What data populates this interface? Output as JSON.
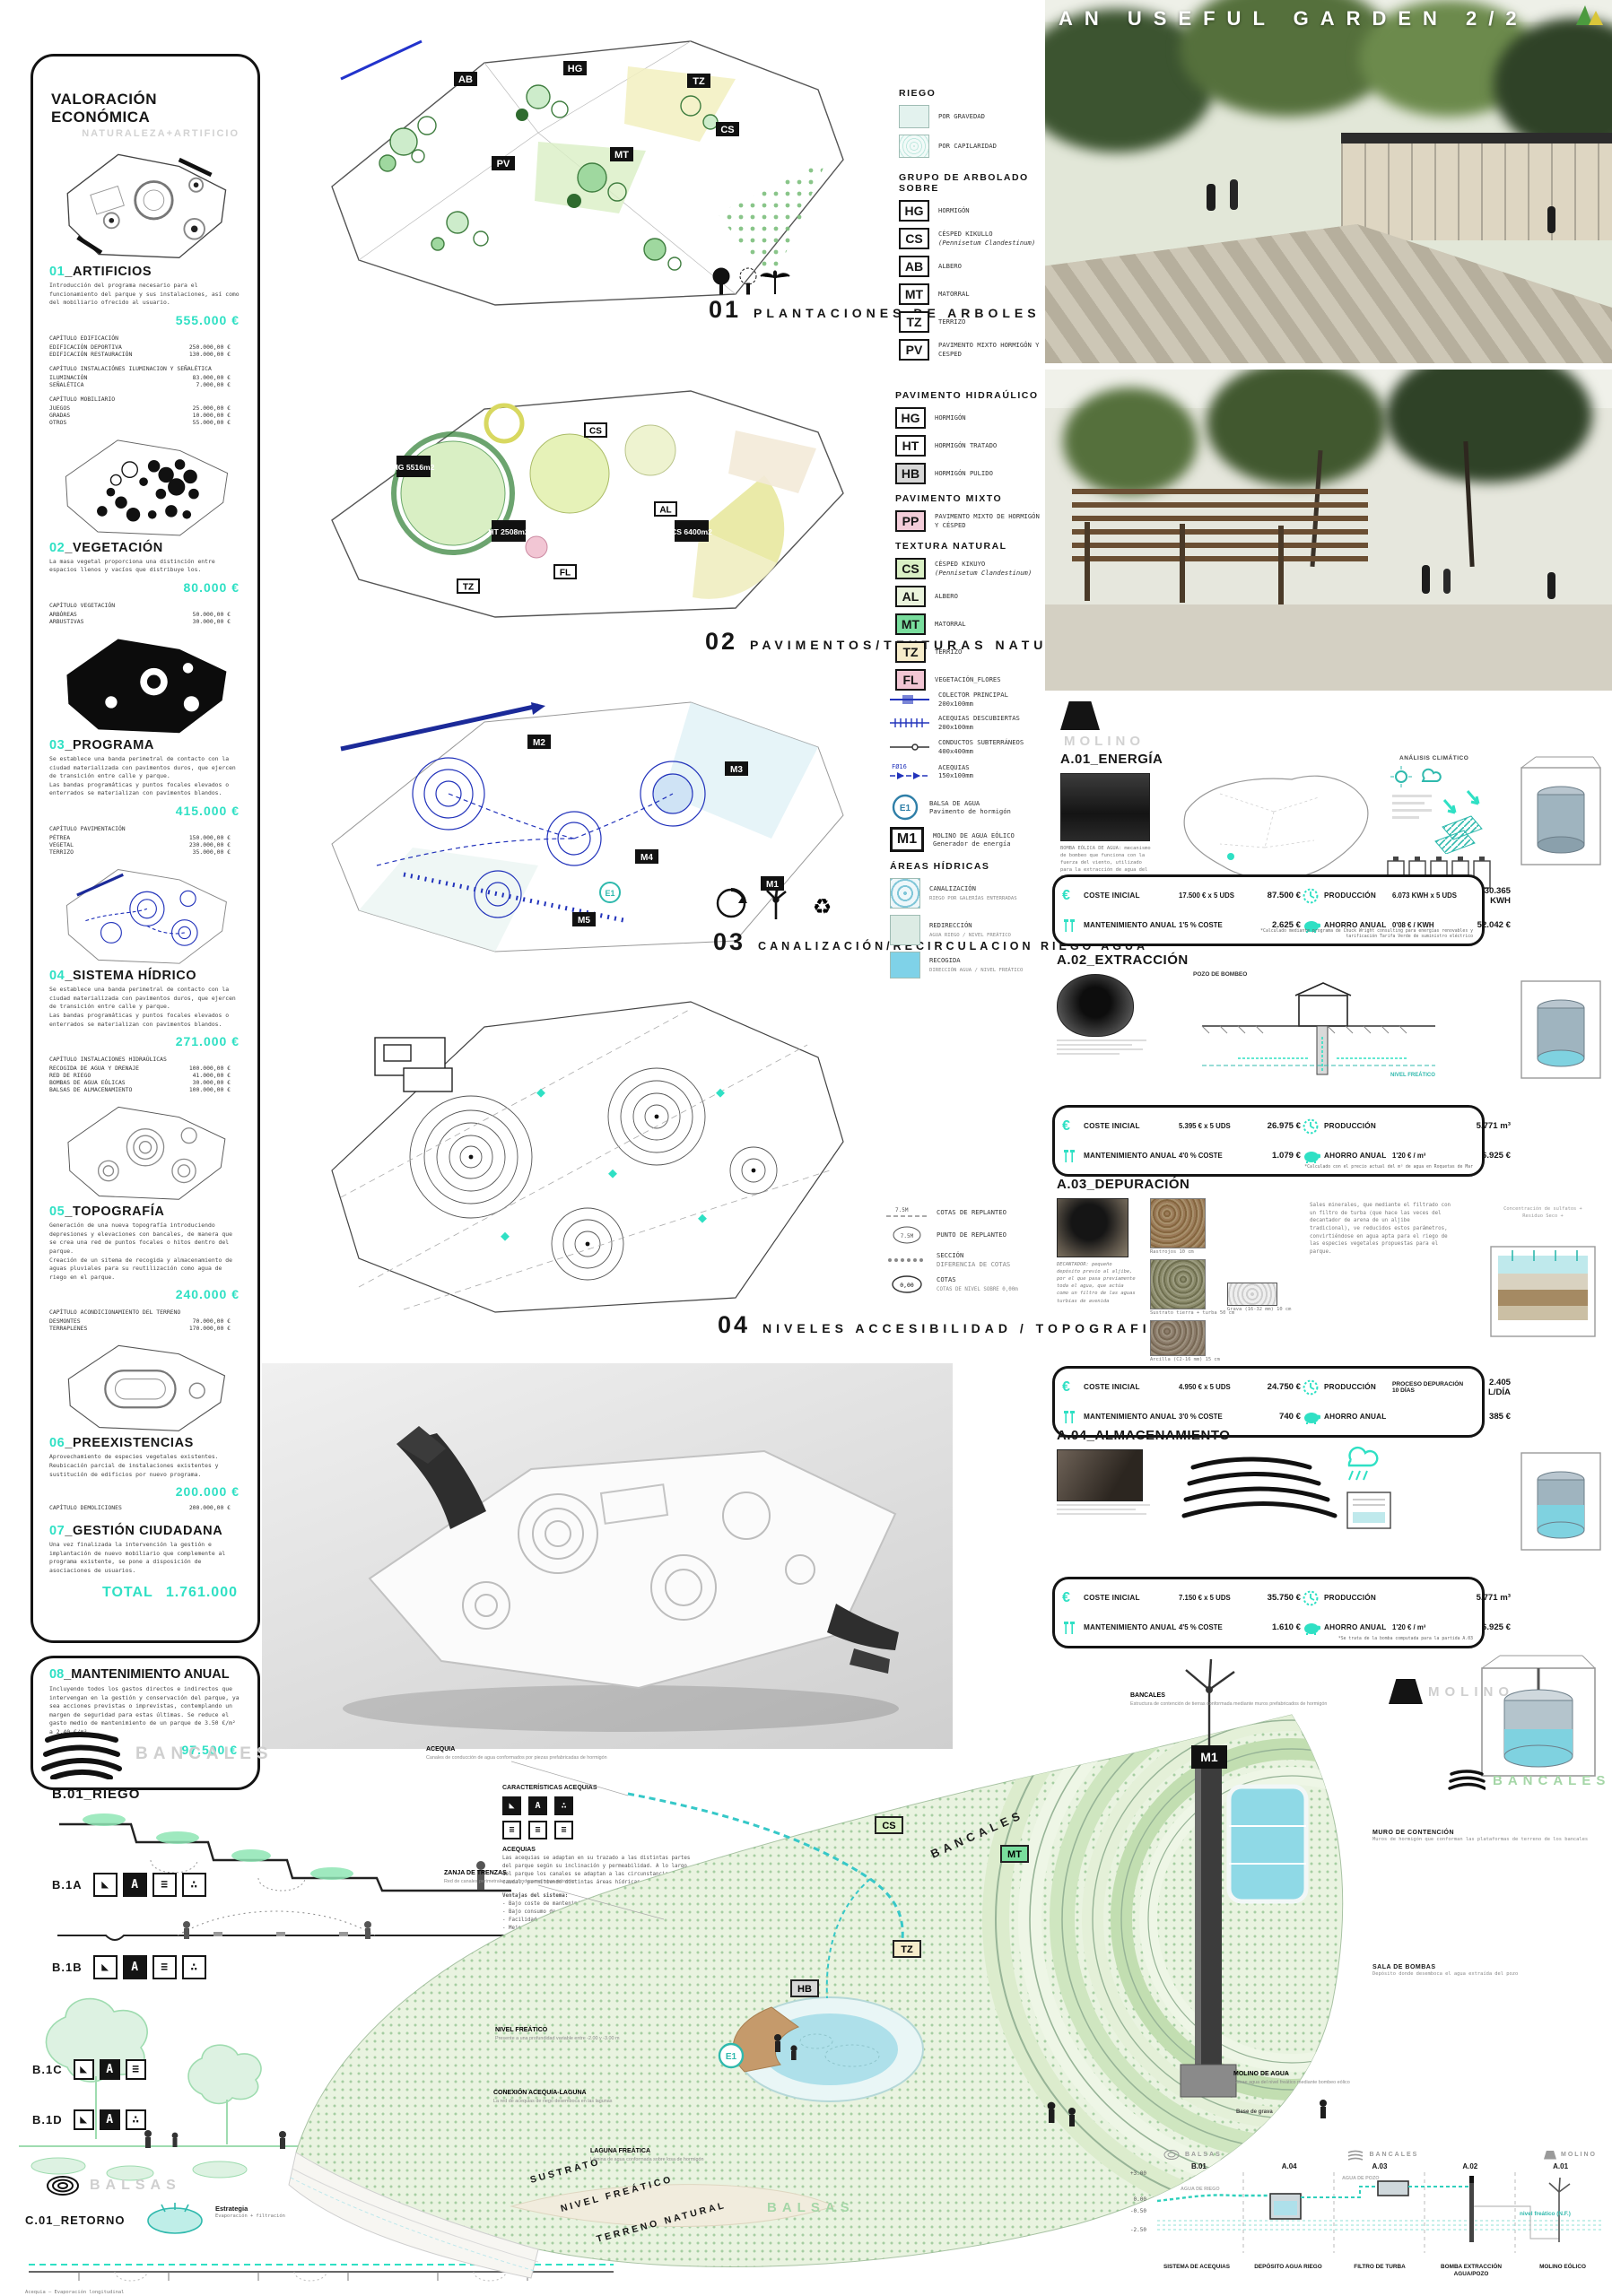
{
  "accent": "#2fe0c4",
  "title": "AN USEFUL GARDEN 2/2",
  "icons": {
    "euro": "€",
    "recycle": "♻"
  },
  "valuation": {
    "title": "VALORACIÓN ECONÓMICA",
    "subtitle": "NATURALEZA+ARTIFICIO",
    "sections": [
      {
        "num": "01",
        "name": "_ARTIFICIOS",
        "desc": "Introducción del programa necesario para el funcionamiento del parque y sus instalaciones, así como del mobiliario ofrecido al usuario.",
        "total": "555.000 €",
        "chapters": [
          {
            "title": "CAPÍTULO EDIFICACIÓN",
            "rows": [
              [
                "EDIFICACIÓN DEPORTIVA",
                "250.000,00 €"
              ],
              [
                "EDIFICACIÓN RESTAURACIÓN",
                "130.000,00 €"
              ]
            ]
          },
          {
            "title": "CAPÍTULO INSTALACIÓNES ILUMINACION Y SEÑALÉTICA",
            "rows": [
              [
                "ILUMINACIÓN",
                "83.000,00 €"
              ],
              [
                "SEÑALÉTICA",
                "7.000,00 €"
              ]
            ]
          },
          {
            "title": "CAPÍTULO MOBILIARIO",
            "rows": [
              [
                "JUEGOS",
                "25.000,00 €"
              ],
              [
                "GRADAS",
                "10.000,00 €"
              ],
              [
                "OTROS",
                "55.000,00 €"
              ]
            ]
          }
        ]
      },
      {
        "num": "02",
        "name": "_VEGETACIÓN",
        "desc": "La masa vegetal proporciona una distinción entre espacios llenos y vacíos que distribuye los.",
        "total": "80.000 €",
        "chapters": [
          {
            "title": "CAPÍTULO VEGETACIÓN",
            "rows": [
              [
                "ARBÓREAS",
                "50.000,00 €"
              ],
              [
                "ARBUSTIVAS",
                "30.000,00 €"
              ]
            ]
          }
        ]
      },
      {
        "num": "03",
        "name": "_PROGRAMA",
        "desc": "Se establece una banda perimetral de contacto con la ciudad materializada con pavimentos duros, que ejercen de transición entre calle y parque.\nLas bandas programáticas y puntos focales elevados o enterrados se materializan con pavimentos blandos.",
        "total": "415.000 €",
        "chapters": [
          {
            "title": "CAPÍTULO PAVIMENTACIÓN",
            "rows": [
              [
                "PÉTREA",
                "150.000,00 €"
              ],
              [
                "VEGETAL",
                "230.000,00 €"
              ],
              [
                "TERRIZO",
                "35.000,00 €"
              ]
            ]
          }
        ]
      },
      {
        "num": "04",
        "name": "_SISTEMA HÍDRICO",
        "desc": "Se establece una banda perimetral de contacto con la ciudad materializada con pavimentos duros, que ejercen de transición entre calle y parque.\nLas bandas programáticas y puntos focales elevados o enterrados se materializan con pavimentos blandos.",
        "total": "271.000 €",
        "chapters": [
          {
            "title": "CAPÍTULO INSTALACIONES HIDRAÚLICAS",
            "rows": [
              [
                "RECOGIDA DE AGUA Y DRENAJE",
                "100.000,00 €"
              ],
              [
                "RED DE RIEGO",
                "41.000,00 €"
              ],
              [
                "BOMBAS DE AGUA EÓLICAS",
                "30.000,00 €"
              ],
              [
                "BALSAS DE ALMACENAMIENTO",
                "100.000,00 €"
              ]
            ]
          }
        ]
      },
      {
        "num": "05",
        "name": "_TOPOGRAFÍA",
        "desc": "Generación de una nueva topografía introduciendo depresiones y elevaciones con bancales, de manera que se crea una red de puntos focales o hitos dentro del parque.\nCreación de un sitema de recogida y almacenamiento de aguas pluviales para su reutilización como agua de riego en el parque.",
        "total": "240.000 €",
        "chapters": [
          {
            "title": "CAPÍTULO ACONDICIONAMIENTO DEL TERRENO",
            "rows": [
              [
                "DESMONTES",
                "70.000,00 €"
              ],
              [
                "TERRAPLENES",
                "170.000,00 €"
              ]
            ]
          }
        ]
      },
      {
        "num": "06",
        "name": "_PREEXISTENCIAS",
        "desc": "Aprovechamiento de especies vegetales existentes.\nReubicación parcial de instalaciones existentes y sustitución de edificios por nuevo programa.",
        "total": "200.000 €",
        "chapters": [
          {
            "title": "",
            "rows": [
              [
                "CAPÍTULO DEMOLICIONES",
                "200.000,00 €"
              ]
            ]
          }
        ]
      },
      {
        "num": "07",
        "name": "_GESTIÓN CIUDADANA",
        "desc": "Una vez finalizada la intervención la gestión e implantación de nuevo mobiliario que complemente al programa existente, se pone a disposición de asociaciones de usuarios.",
        "total": "",
        "chapters": []
      }
    ],
    "grand_total_label": "TOTAL",
    "grand_total": "1.761.000",
    "maintenance": {
      "num": "08",
      "name": "_MANTENIMIENTO ANUAL",
      "desc": "Incluyendo todos los gastos directos e indirectos que intervengan en la gestión y conservación del parque, ya sea acciones previstas o imprevistas, contemplando un margen de seguridad para estas últimas. Se reduce el gasto medio de mantenimiento de un parque de 3.50 €/m² a 2.40 €/m².",
      "total": "97.500 €"
    }
  },
  "plans": [
    {
      "num": "01",
      "caption": "PLANTACIONES DE ARBOLES Y ARBUSTOS",
      "tags": [
        "AB",
        "HG",
        "TZ",
        "PV",
        "MT",
        "CS"
      ]
    },
    {
      "num": "02",
      "caption": "PAVIMENTOS/TEXTURAS NATURALES",
      "tags": [
        "HG 5516m2",
        "HT 2508m2",
        "CS 6400m2"
      ],
      "chips": [
        "CS",
        "AL",
        "TZ",
        "FL"
      ]
    },
    {
      "num": "03",
      "caption": "CANALIZACIÓN/RECIRCULACION RIEGO AGUA",
      "tags": [
        "M1",
        "M2",
        "M3",
        "M4",
        "M5"
      ]
    },
    {
      "num": "04",
      "caption": "NIVELES ACCESIBILIDAD / TOPOGRAFIA",
      "tags": []
    }
  ],
  "legend1": {
    "riego_title": "RIEGO",
    "riego": [
      "POR GRAVEDAD",
      "POR CAPILARIDAD"
    ],
    "arbolado_title": "GRUPO DE ARBOLADO SOBRE",
    "items": [
      {
        "code": "HG",
        "label": "HORMIGÓN",
        "latin": ""
      },
      {
        "code": "CS",
        "label": "CÉSPED KIKULLO",
        "latin": "(Pennisetum Clandestinum)"
      },
      {
        "code": "AB",
        "label": "ALBERO",
        "latin": ""
      },
      {
        "code": "MT",
        "label": "MATORRAL",
        "latin": ""
      },
      {
        "code": "TZ",
        "label": "TERRIZO",
        "latin": ""
      },
      {
        "code": "PV",
        "label": "PAVIMENTO MIXTO HORMIGÓN Y CESPED",
        "latin": ""
      }
    ]
  },
  "legend2": {
    "g1_title": "PAVIMENTO HIDRAÚLICO",
    "g1": [
      {
        "code": "HG",
        "label": "HORMIGÓN"
      },
      {
        "code": "HT",
        "label": "HORMIGÓN TRATADO"
      },
      {
        "code": "HB",
        "label": "HORMIGÓN PULIDO"
      }
    ],
    "g2_title": "PAVIMENTO MIXTO",
    "g2": [
      {
        "code": "PP",
        "label": "PAVIMENTO MIXTO DE HORMIGÓN Y CÉSPED"
      }
    ],
    "g3_title": "TEXTURA NATURAL",
    "g3": [
      {
        "code": "CS",
        "label": "CÉSPED KIKUYO",
        "latin": "(Pennisetum Clandestinum)"
      },
      {
        "code": "AL",
        "label": "ALBERO",
        "latin": ""
      },
      {
        "code": "MT",
        "label": "MATORRAL",
        "latin": ""
      },
      {
        "code": "TZ",
        "label": "TERRIZO",
        "latin": ""
      },
      {
        "code": "FL",
        "label": "VEGETACIÓN_FLORES",
        "latin": ""
      }
    ]
  },
  "legend3": {
    "lines": [
      {
        "label": "COLECTOR PRINCIPAL",
        "size": "200x100mm"
      },
      {
        "label": "ACEQUIAS DESCUBIERTAS",
        "size": "200x100mm"
      },
      {
        "label": "CONDUCTOS SUBTERRÁNEOS",
        "size": "400x400mm"
      },
      {
        "label": "ACEQUIAS",
        "size": "150x100mm",
        "note": "FØ16"
      }
    ],
    "e1_code": "E1",
    "e1_label": "BALSA DE AGUA",
    "e1_sub": "Pavimento de hormigón",
    "m1_code": "M1",
    "m1_label": "MOLINO DE AGUA EÓLICO",
    "m1_sub": "Generador de energía",
    "areas_title": "ÁREAS HÍDRICAS",
    "areas": [
      {
        "label": "CANALIZACIÓN",
        "sub": "RIEGO POR GALERÍAS ENTERRADAS"
      },
      {
        "label": "REDIRECCIÓN",
        "sub": "AGUA RIEGO / NIVEL FREÁTICO"
      },
      {
        "label": "RECOGIDA",
        "sub": "DIRECCIÓN AGUA / NIVEL FREÁTICO"
      }
    ]
  },
  "legend4": {
    "items": [
      {
        "sym": "7.5M",
        "label": "COTAS DE REPLANTEO",
        "sub": ""
      },
      {
        "sym": "7.5M",
        "label": "PUNTO DE REPLANTEO",
        "sub": ""
      },
      {
        "sym": "",
        "label": "SECCIÓN",
        "sub": "DIFERENCIA DE COTAS"
      },
      {
        "sym": "0,00",
        "label": "COTAS",
        "sub": "COTAS DE NIVEL SOBRE 0,00m"
      }
    ]
  },
  "modules": [
    {
      "tag": "MOLINO",
      "header": "A.01_ENERGÍA",
      "note": "SISTEMA HÍBRIDO DE PRODUCCIÓN DE ENERGÍA EÓLICA-SOLAR",
      "extra": "ANÁLISIS CLIMÁTICO",
      "photo_caption": "BOMBA EÓLICA DE AGUA: mecanismo de bombeo que funciona con la fuerza del viento, utilizado para la extracción de agua del subsuelo a la red de riego.",
      "t": {
        "ci": "COSTE INICIAL",
        "ci1": "17.500 € x 5 UDS",
        "ci2": "87.500 €",
        "ma": "MANTENIMIENTO ANUAL",
        "ma1": "1'5 % COSTE",
        "ma2": "2.625 €",
        "pr": "PRODUCCIÓN",
        "pr1": "6.073 KWH x 5 UDS",
        "pr2": "30.365 KWH",
        "ah": "AHORRO ANUAL",
        "ah1": "0'08 € / KWH",
        "ah2": "52.042 €"
      },
      "footnote": "*Calculado mediante programa de Chuck Wright consulting para energías renovables y tarificación Tarifa Verde de suministro eléctrico"
    },
    {
      "header": "A.02_EXTRACCIÓN",
      "labels": [
        "POZO DE BOMBEO",
        "NIVEL FREÁTICO"
      ],
      "t": {
        "ci": "COSTE INICIAL",
        "ci1": "5.395 € x 5 UDS",
        "ci2": "26.975 €",
        "ma": "MANTENIMIENTO ANUAL",
        "ma1": "4'0 % COSTE",
        "ma2": "1.079 €",
        "pr": "PRODUCCIÓN",
        "pr1": "",
        "pr2": "5.771 m³",
        "ah": "AHORRO ANUAL",
        "ah1": "1'20 € / m³",
        "ah2": "6.925 €"
      },
      "footnote": "*Calculado con el precio actual del m³ de agua en Roquetas de Mar"
    },
    {
      "header": "A.03_DEPURACIÓN",
      "soil": [
        "Rastrojos 10 cm",
        "Sustrato tierra + turba 50 cm",
        "Arcilla (C2-16 mm) 15 cm",
        "Grava (16-32 mm) 10 cm"
      ],
      "quote": "DECANTADOR: pequeño depósito previo al aljibe, por el que pasa previamente toda el agua, que actúa como un filtro de las aguas turbias de avenida",
      "desc": "Sales minerales, que mediante el filtrado con un filtro de turba (que hace las veces del decantador de arena de un aljibe tradicional), ve reducidos estos parámetros, convirtiéndose en agua apta para el riego de las especies vegetales propuestas para el parque.",
      "params": [
        "Concentración de sulfatos +",
        "Residuo Seco +"
      ],
      "t": {
        "ci": "COSTE INICIAL",
        "ci1": "4.950 € x 5 UDS",
        "ci2": "24.750 €",
        "ma": "MANTENIMIENTO ANUAL",
        "ma1": "3'0 % COSTE",
        "ma2": "740 €",
        "pr": "PRODUCCIÓN",
        "pr1": "PROCESO DEPURACIÓN 10 DÍAS",
        "pr2": "2.405 L/DÍA",
        "ah": "AHORRO ANUAL",
        "ah1": "",
        "ah2": "385 €"
      },
      "footnote": ""
    },
    {
      "header": "A.04_ALMACENAMIENTO",
      "t": {
        "ci": "COSTE INICIAL",
        "ci1": "7.150 € x 5 UDS",
        "ci2": "35.750 €",
        "ma": "MANTENIMIENTO ANUAL",
        "ma1": "4'5 % COSTE",
        "ma2": "1.610 €",
        "pr": "PRODUCCIÓN",
        "pr1": "",
        "pr2": "5.771 m³",
        "ah": "AHORRO ANUAL",
        "ah1": "1'20 € / m³",
        "ah2": "6.925 €"
      },
      "footnote": "*Se trata de la bomba computada para la partida A.03"
    }
  ],
  "bottom": {
    "bancales_label": "BANCALES",
    "riego_header": "B.01_RIEGO",
    "b_items": [
      "B.1A",
      "B.1B",
      "B.1C",
      "B.1D"
    ],
    "chip_glyphs": [
      "◣",
      "A",
      "≡",
      "∴"
    ],
    "balsas_label": "BALSAS",
    "retorno_header": "C.01_RETORNO",
    "retorno_title": "Estrategia",
    "retorno_sub": "Evaporación + filtración",
    "acequia_long": "Acequia — Evaporación longitudinal",
    "carac_title": "CARACTERÍSTICAS ACEQUIAS",
    "acequias_title": "ACEQUIAS",
    "acequias_para": "Las acequias se adaptan en su trazado a las distintas partes del parque según su inclinación y permeabilidad. A lo largo del parque los canales se adaptan a las circunstancias de caudal, permitiendo distintas áreas hídricas.",
    "ventajas_title": "Ventajas del sistema:",
    "ventajas": [
      "- Bajo coste de mantenimiento y explotación",
      "- Bajo consumo de energía",
      "- Facilidad de construcción",
      "- Mejora del confort",
      "- Dimensionado de la red, evitando atascos por sales minerales",
      "- Eficiencia de riego",
      "- Control eficaz del agua"
    ],
    "notes": "ALTURA COTA MÁXIMA +3.50m\nPROFUNDIDAD MÁXIMA DE LAS BALSAS -0.50m\nPROFUNDIDAD MÁXIMA LÁMINAS DE AGUA -0.30m",
    "strata": [
      "SUSTRATO",
      "NIVEL FREÁTICO",
      "TERRENO NATURAL"
    ],
    "tags": {
      "cs": "CS",
      "mt": "MT",
      "tz": "TZ",
      "hb": "HB",
      "e1": "E1",
      "m1": "M1"
    },
    "labels": {
      "bancales_right": "BANCALES",
      "bancales_slope": "BANCALES",
      "balsas_green": "BALSAS",
      "molino": "MOLINO"
    },
    "callouts": [
      {
        "t": "ACEQUIA",
        "d": "Canales de conducción de agua conformados por piezas prefabricadas de hormigón"
      },
      {
        "t": "ZANJA DE TRENZAS",
        "d": "Red de canales perimetrales que conducen el agua sobrante"
      },
      {
        "t": "NIVEL FREÁTICO",
        "d": "Presente a una profundidad variable entre -2.00 y -3.00 m"
      },
      {
        "t": "CONEXIÓN ACEQUIA-LAGUNA",
        "d": "La red de acequias de riego desemboca en las lagunas"
      },
      {
        "t": "LAGUNA FREÁTICA",
        "d": "Lámina de agua conformada sobre losa de hormigón"
      },
      {
        "t": "BANCALES",
        "d": "Estructura de contención de tierras conformada mediante muros prefabricados de hormigón"
      },
      {
        "t": "MOLINO DE AGUA",
        "d": "Extrae agua del nivel freático mediante bombeo eólico"
      },
      {
        "t": "Base de grava",
        "d": ""
      },
      {
        "t": "MURO DE CONTENCIÓN",
        "d": "Muros de hormigón que conforman las plataformas de terreno de los bancales"
      },
      {
        "t": "SALA DE BOMBAS",
        "d": "Depósito donde desemboca el agua extraída del pozo"
      }
    ],
    "schematic": {
      "codes": [
        "B.01",
        "A.04",
        "A.03",
        "A.02",
        "A.01"
      ],
      "cols": [
        "SISTEMA DE ACEQUIAS",
        "DEPÓSITO AGUA RIEGO",
        "FILTRO DE TURBA",
        "BOMBA EXTRACCIÓN AGUA/POZO",
        "MOLINO EÓLICO"
      ],
      "top": [
        "BALSAS",
        "BANCALES",
        "MOLINO"
      ],
      "levels": [
        "+3.00",
        "0.00",
        "-0.50",
        "-2.50"
      ],
      "nf": "nivel freático (N.F.)",
      "flows": [
        "AGUA DE RIEGO",
        "AGUA DE POZO"
      ]
    }
  }
}
